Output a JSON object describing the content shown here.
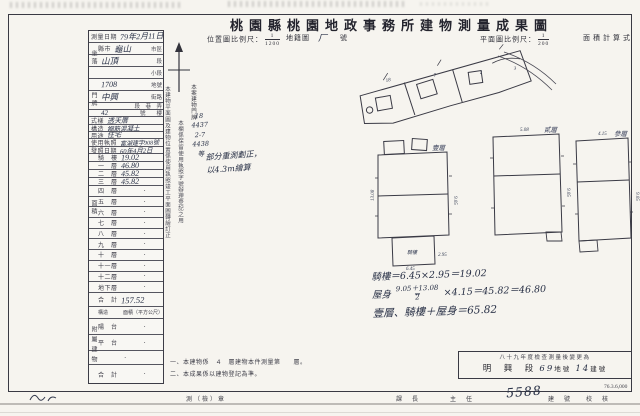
{
  "page": {
    "title": "桃園縣桃園地政事務所建物測量成果圖",
    "print_code": "76.3.6,000"
  },
  "scales": {
    "location_label": "位置圖比例尺：",
    "location_num": "1",
    "location_den": "1200",
    "cadastral_label": "地籍圖",
    "cadastral_hand": "厂",
    "cadastral_suffix": "號",
    "plan_label": "平面圖比例尺：",
    "plan_num": "1",
    "plan_den": "200",
    "area_calc_label": "面積計算式"
  },
  "t": {
    "spine_site": "坐落",
    "spine_door": "門牌",
    "spine_area": "面積",
    "spine_annex": "附屬建物",
    "rows": [
      {
        "l": "測量日期",
        "v": "79年2月11日",
        "s": ""
      },
      {
        "l": "縣市",
        "v": "龜山",
        "s": "市區"
      },
      {
        "l": "",
        "v": "山頂",
        "s": "段"
      },
      {
        "l": "",
        "v": "",
        "s": "小段"
      },
      {
        "l": "",
        "v": "1708",
        "s": "地號"
      },
      {
        "l": "",
        "v": "中興",
        "s": "街路"
      },
      {
        "l": "",
        "v": "",
        "s": "段　巷　弄"
      },
      {
        "l": "",
        "v": "42",
        "s": "號　　樓"
      },
      {
        "l": "式樣",
        "v": "透天厝",
        "s": ""
      },
      {
        "l": "構造",
        "v": "鋼筋混凝土",
        "s": ""
      },
      {
        "l": "用途",
        "v": "住宅",
        "s": ""
      },
      {
        "l": "使用執照",
        "v": "富湖建字908號",
        "s": ""
      },
      {
        "l": "發照日期",
        "v": "60年4月2日",
        "s": ""
      },
      {
        "l": "騎　樓",
        "v": "19.02",
        "s": ""
      },
      {
        "l": "一　層",
        "v": "46.80",
        "s": ""
      },
      {
        "l": "二　層",
        "v": "45.82",
        "s": ""
      },
      {
        "l": "三　層",
        "v": "45.82",
        "s": ""
      },
      {
        "l": "四　層",
        "v": "·",
        "s": ""
      },
      {
        "l": "五　層",
        "v": "·",
        "s": ""
      },
      {
        "l": "六　層",
        "v": "·",
        "s": ""
      },
      {
        "l": "七　層",
        "v": "·",
        "s": ""
      },
      {
        "l": "八　層",
        "v": "·",
        "s": ""
      },
      {
        "l": "九　層",
        "v": "·",
        "s": ""
      },
      {
        "l": "十　層",
        "v": "·",
        "s": ""
      },
      {
        "l": "十一層",
        "v": "·",
        "s": ""
      },
      {
        "l": "十二層",
        "v": "·",
        "s": ""
      },
      {
        "l": "地下層",
        "v": "·",
        "s": ""
      },
      {
        "l": "合　計",
        "v": "157.52",
        "s": ""
      },
      {
        "c1": "構造",
        "c2": "面積（平方公尺）"
      },
      {
        "l": "陽　台",
        "v": "·",
        "s": ""
      },
      {
        "l": "平　台",
        "v": "·",
        "s": ""
      },
      {
        "l": "",
        "v": "·",
        "s": ""
      },
      {
        "l": "合　計",
        "v": "·",
        "s": ""
      }
    ]
  },
  "vnotes": {
    "colA": "本建物平面圖及建物位置係使用執照竣工平面圖轉繪訂正",
    "colB": "本欄係保留使用執照字號辦理登記之用",
    "colC": "本案建物門牌",
    "hand_numbers": "18\n4437\n2-7\n4438\n等",
    "sketch_note1": "部分重測劃正，",
    "sketch_note2": "以4.3m繪算",
    "note1": "一、本建物係　４　層建物本件測量第　　層。",
    "note2": "二、本成果係以建物登記為準。"
  },
  "calc": {
    "line1": "騎樓＝6.45×2.95＝19.02",
    "line2_head": "屋身",
    "frac_num": "9.05＋13.08",
    "frac_den": "2",
    "line2_tail": "×4.15＝45.82＝46.80",
    "line3": "壹層、騎樓＋屋身＝65.82"
  },
  "plans": {
    "p1": {
      "label": "壹層",
      "annex": "騎樓",
      "d_left": "13.08",
      "d_right": "9.05",
      "d_bot": "6.45",
      "d_ext": "2.95"
    },
    "p2": {
      "label": "貳層",
      "d_top": "5.08",
      "d_right": "9.05"
    },
    "p3": {
      "label": "參層",
      "d_top": "4.15",
      "d_right": "9.05"
    }
  },
  "change_box": {
    "line1": "八十九年度檢查測量後變更為",
    "section": "明　興　段",
    "lot": "69",
    "lot_suffix": "地號",
    "bldg": "14",
    "bldg_suffix": "建號"
  },
  "footer": {
    "seal_label": "測（檢）章",
    "chief_label": "課　長",
    "director_label": "主　任",
    "number_hand": "5588",
    "bldg_label": "建　號",
    "check_label": "校　核",
    "print_code": "76.3.6,000"
  }
}
